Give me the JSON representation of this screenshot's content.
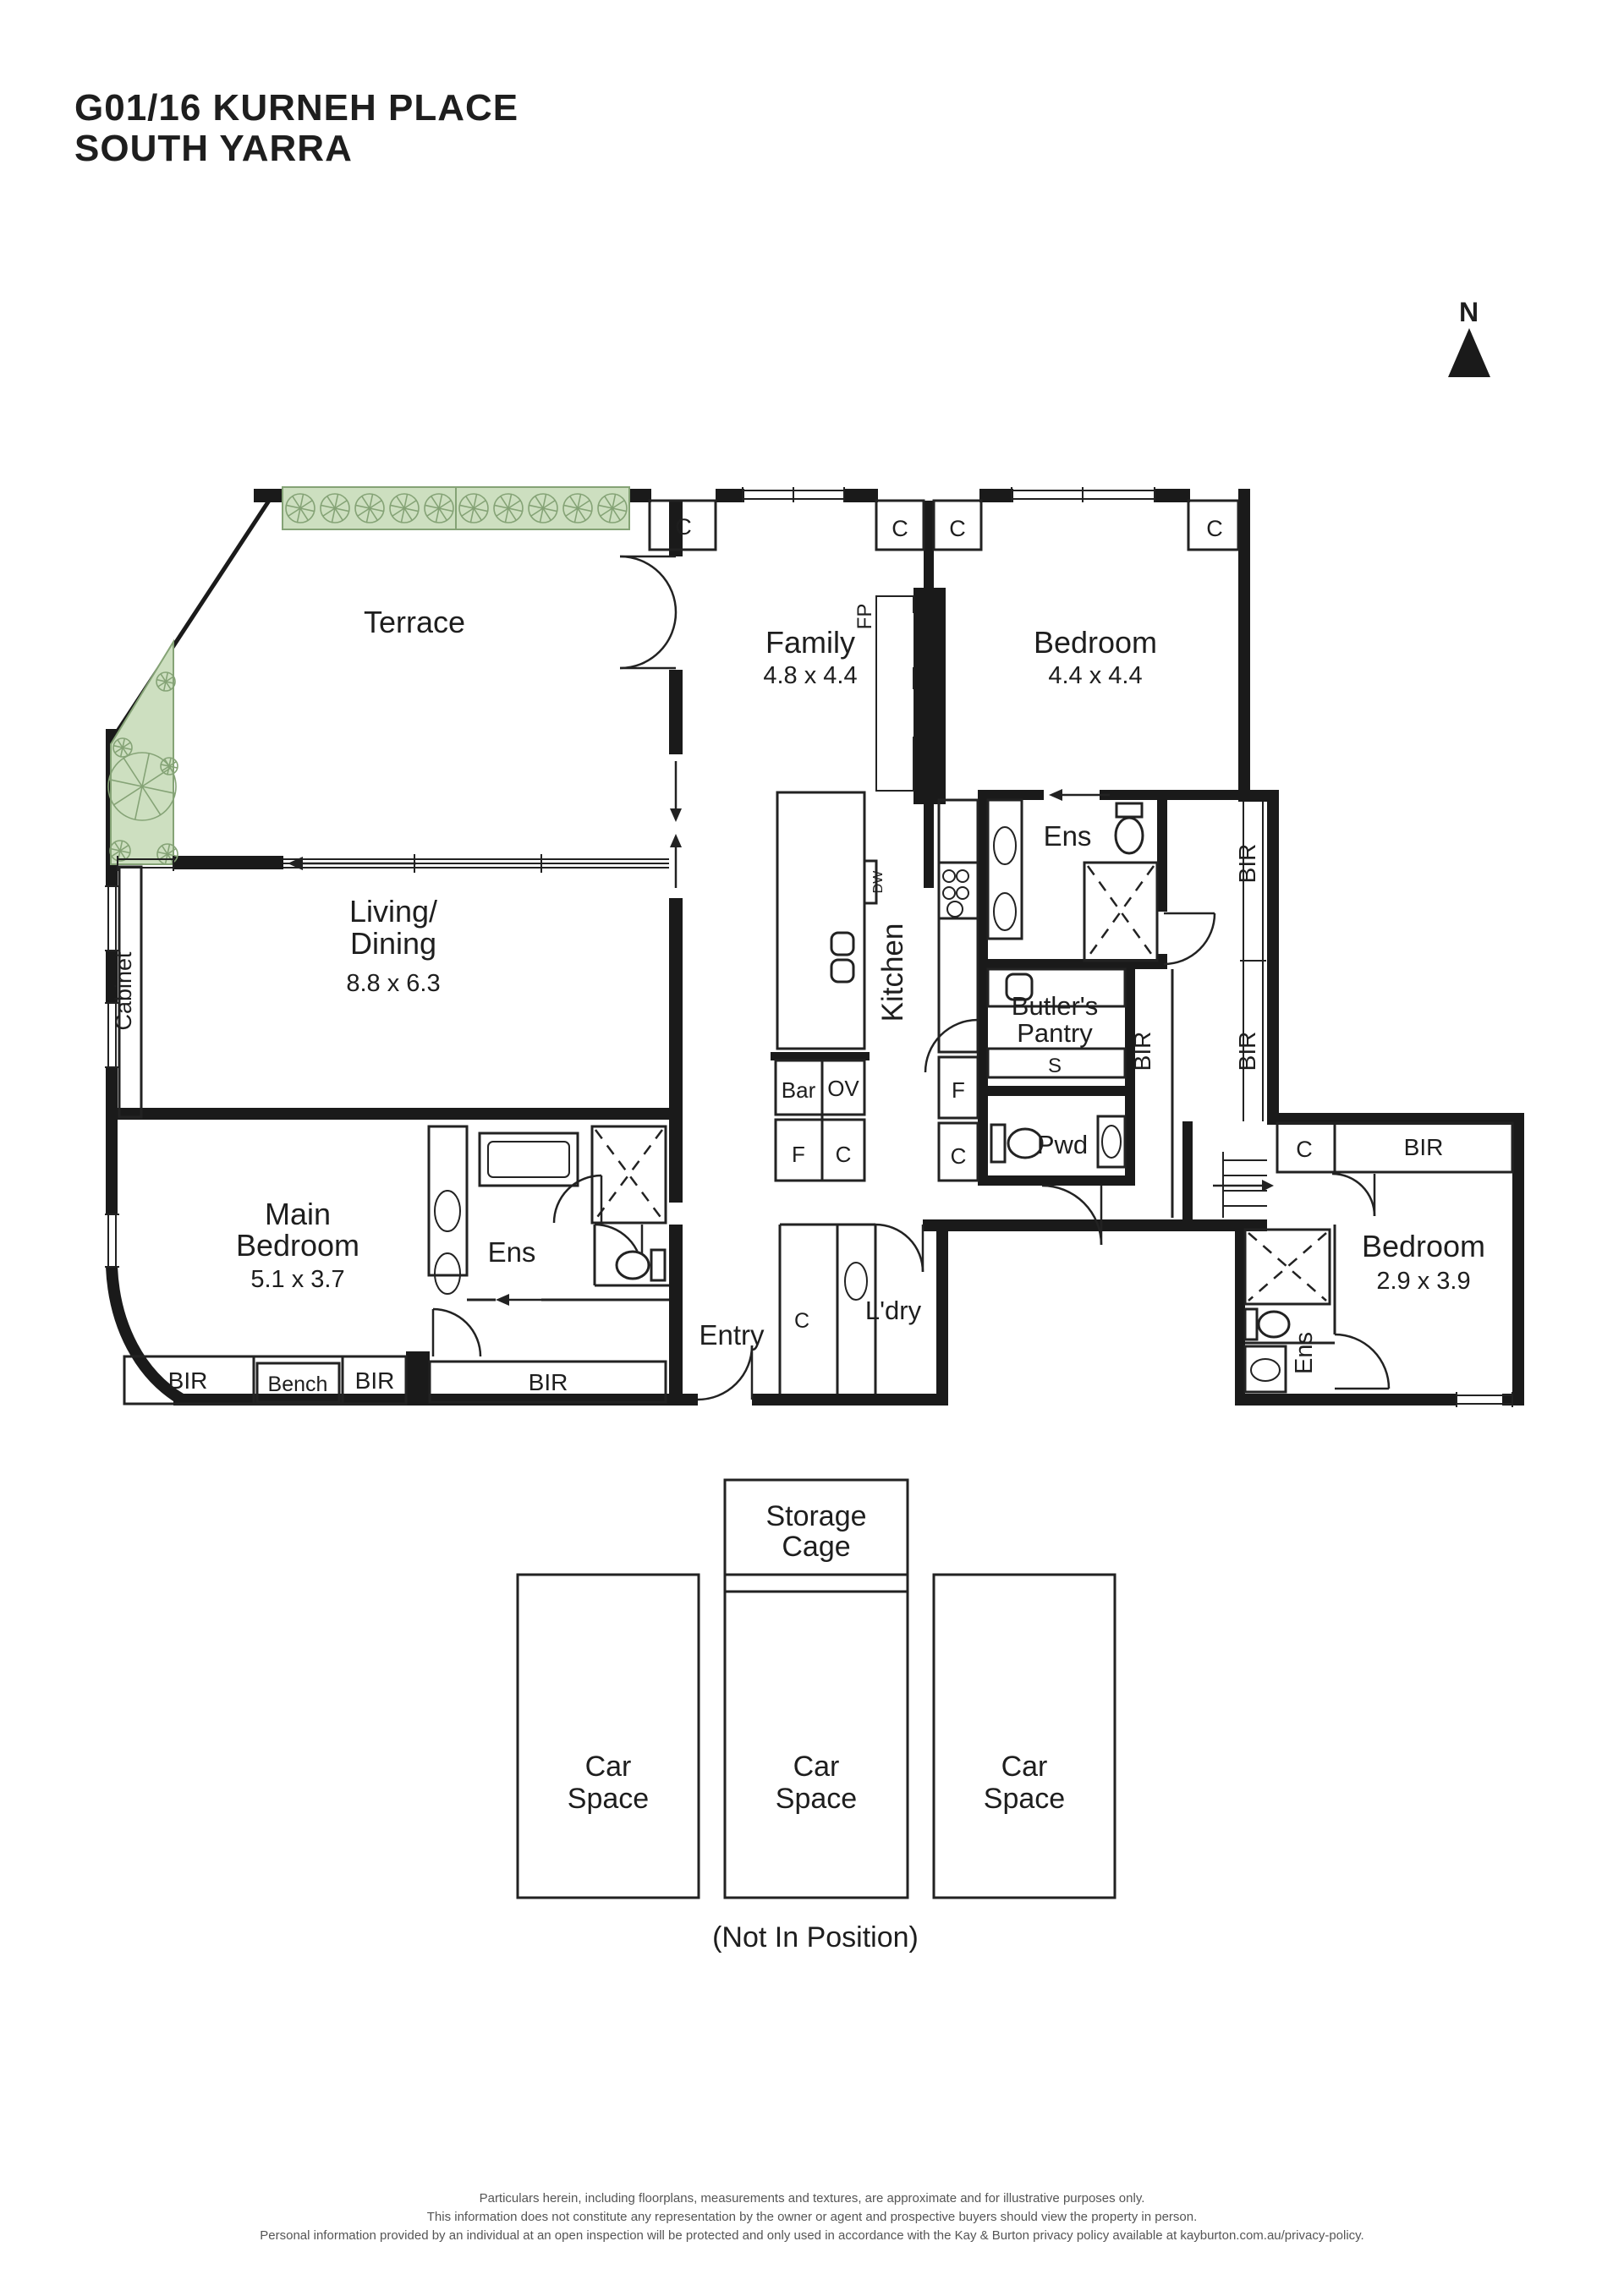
{
  "title": {
    "line1": "G01/16 KURNEH PLACE",
    "line2": "SOUTH YARRA"
  },
  "north_label": "N",
  "rooms": {
    "terrace": {
      "name": "Terrace"
    },
    "family": {
      "name": "Family",
      "dims": "4.8 x 4.4"
    },
    "bedroom_top": {
      "name": "Bedroom",
      "dims": "4.4 x 4.4"
    },
    "living": {
      "line1": "Living/",
      "line2": "Dining",
      "dims": "8.8 x 6.3"
    },
    "kitchen": {
      "name": "Kitchen"
    },
    "butlers_pantry": {
      "line1": "Butler's",
      "line2": "Pantry"
    },
    "main_bedroom": {
      "line1": "Main",
      "line2": "Bedroom",
      "dims": "5.1 x 3.7"
    },
    "bedroom_right": {
      "name": "Bedroom",
      "dims": "2.9 x 3.9"
    },
    "entry": {
      "name": "Entry"
    },
    "laundry": {
      "name": "L'dry"
    },
    "powder": {
      "name": "Pwd"
    },
    "ensuite": {
      "name": "Ens"
    }
  },
  "labels": {
    "closet": "C",
    "robe": "BIR",
    "bench": "Bench",
    "bar": "Bar",
    "oven": "OV",
    "fridge": "F",
    "sink": "S",
    "fireplace": "FP",
    "dishwasher": "DW",
    "cabinet": "Cabinet"
  },
  "parking": {
    "storage_line1": "Storage",
    "storage_line2": "Cage",
    "car_line1": "Car",
    "car_line2": "Space",
    "note": "(Not In Position)"
  },
  "disclaimer": {
    "line1": "Particulars herein, including floorplans, measurements and textures, are approximate and for illustrative purposes only.",
    "line2": "This information does not constitute any representation by the owner or agent and prospective buyers should view the property in person.",
    "line3": "Personal information provided by an individual at an open inspection will be protected and only used in accordance with the Kay & Burton privacy policy available at kayburton.com.au/privacy-policy."
  },
  "colors": {
    "wall": "#1a1a1a",
    "line": "#222222",
    "text": "#1e1e1e",
    "planter_fill": "#cddfc0",
    "planter_stroke": "#85a376",
    "disclaimer_text": "#555555"
  }
}
